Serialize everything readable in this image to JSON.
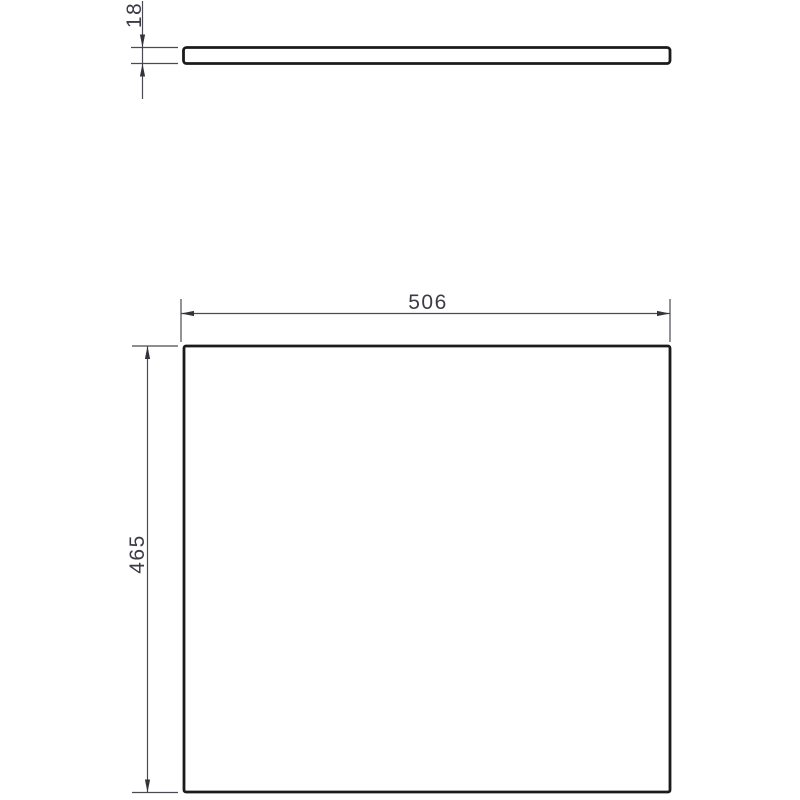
{
  "drawing": {
    "type": "technical-dimension-drawing",
    "background_color": "#ffffff",
    "outline_color": "#1b1b1d",
    "dimension_line_color": "#4a4a52",
    "text_color": "#3b3b44",
    "views": [
      {
        "id": "edge-view",
        "description": "thin horizontal panel seen from its edge (top of sheet)"
      },
      {
        "id": "front-view",
        "description": "large rectangular panel face (bottom of sheet)"
      }
    ],
    "dimensions": [
      {
        "id": "thickness",
        "value": "18",
        "orientation": "vertical",
        "applies_to": "edge-view",
        "style": "arrows-outside"
      },
      {
        "id": "width",
        "value": "506",
        "orientation": "horizontal",
        "applies_to": "front-view",
        "style": "arrows-inside"
      },
      {
        "id": "height",
        "value": "465",
        "orientation": "vertical",
        "applies_to": "front-view",
        "style": "arrows-inside"
      }
    ]
  }
}
